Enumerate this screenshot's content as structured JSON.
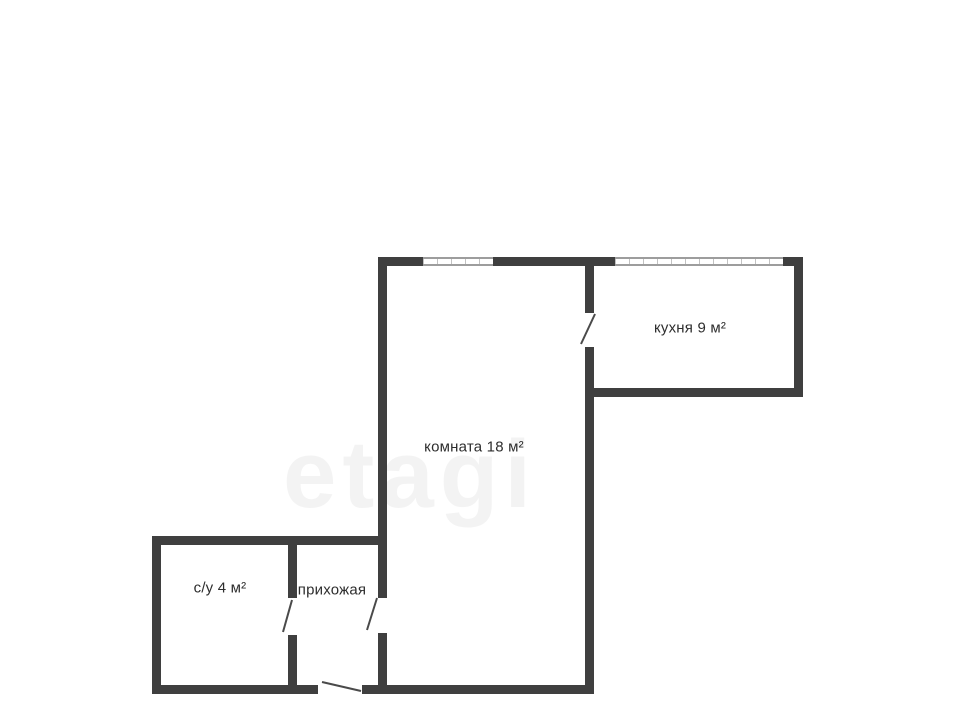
{
  "plan": {
    "title": "apartment-floor-plan",
    "colors": {
      "background": "#ffffff",
      "wall": "#3f3f3f",
      "text": "#2d2d2d",
      "window_line": "#9d9d9d",
      "door_line": "#4a4a4a"
    },
    "rooms": [
      {
        "id": "kitchen",
        "label": "кухня 9 м²"
      },
      {
        "id": "room",
        "label": "комната 18 м²"
      },
      {
        "id": "bathroom",
        "label": "с/у 4 м²"
      },
      {
        "id": "hallway",
        "label": "прихожая"
      }
    ],
    "watermark": {
      "text": "etagi"
    }
  }
}
